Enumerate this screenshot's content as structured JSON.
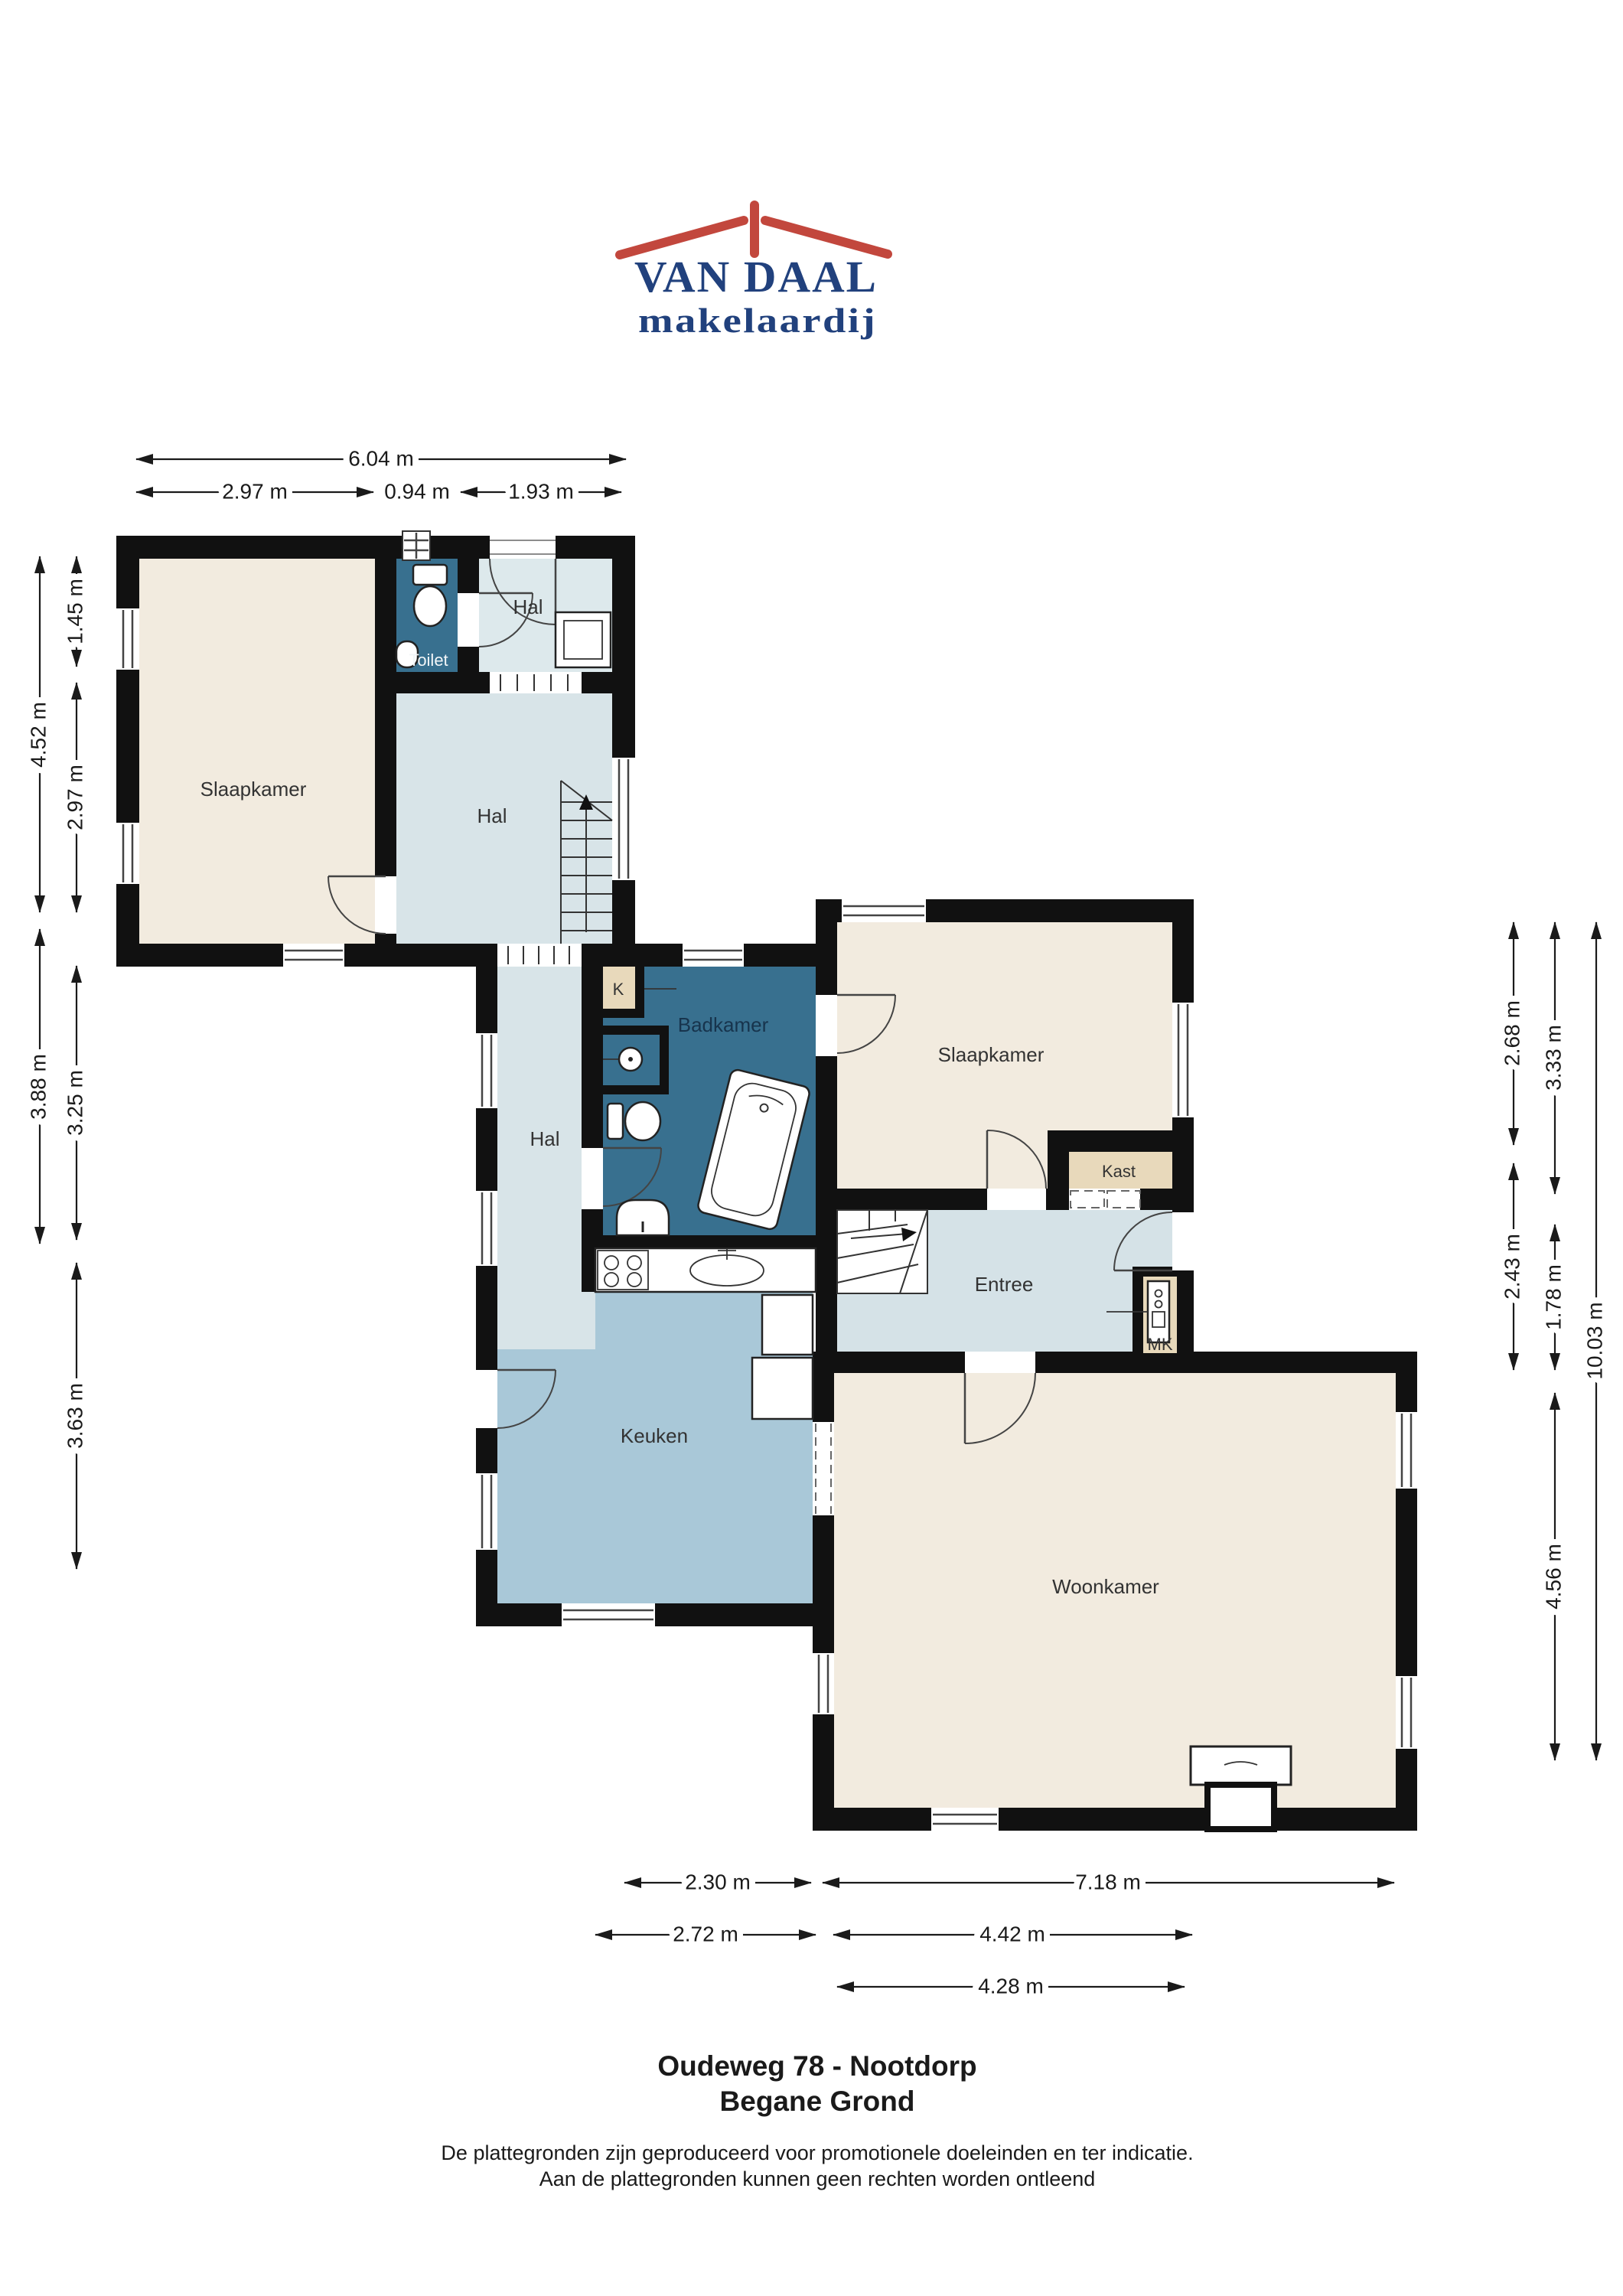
{
  "logo": {
    "name": "VAN DAAL",
    "tagline": "makelaardij",
    "roof_color": "#c2473d",
    "text_color": "#21417d"
  },
  "rooms": {
    "slaapkamer_left": "Slaapkamer",
    "hal_top": "Hal",
    "toilet": "Toilet",
    "hal_main": "Hal",
    "hal_corridor": "Hal",
    "closet_k": "K",
    "badkamer": "Badkamer",
    "slaapkamer_right": "Slaapkamer",
    "kast": "Kast",
    "entree": "Entree",
    "meterkast": "MK",
    "keuken": "Keuken",
    "woonkamer": "Woonkamer"
  },
  "dimensions": {
    "top": {
      "total": "6.04 m",
      "left": "2.97 m",
      "middle": "0.94 m",
      "right": "1.93 m"
    },
    "left": {
      "upper_outer": "4.52 m",
      "upper_inner_top": "1.45 m",
      "upper_inner_bottom": "2.97 m",
      "lower_outer": "3.88 m",
      "lower_inner_top": "3.25 m",
      "lower_inner_bottom": "3.63 m"
    },
    "right": {
      "inner_top": "2.68 m",
      "inner_bottom": "2.43 m",
      "middle_top": "3.33 m",
      "middle_mid": "1.78 m",
      "middle_bottom": "4.56 m",
      "outer": "10.03 m"
    },
    "bottom": {
      "row1_left": "2.30 m",
      "row1_right": "7.18 m",
      "row2_left": "2.72 m",
      "row2_right": "4.42 m",
      "row3": "4.28 m"
    }
  },
  "footer": {
    "title_line1": "Oudeweg 78 - Nootdorp",
    "title_line2": "Begane Grond",
    "disclaimer_line1": "De plattegronden zijn geproduceerd voor promotionele doeleinden en ter indicatie.",
    "disclaimer_line2": "Aan de plattegronden kunnen geen rechten worden ontleend"
  },
  "colors": {
    "wall": "#111111",
    "bedroom_living": "#f2ebdf",
    "hall": "#d8e4e8",
    "hall_light": "#dde9ec",
    "entree": "#d5e2e7",
    "kitchen": "#a9c8d8",
    "bathroom": "#38708f",
    "closet": "#e8d9bb",
    "logo_blue": "#21417d",
    "logo_red": "#c2473d"
  }
}
